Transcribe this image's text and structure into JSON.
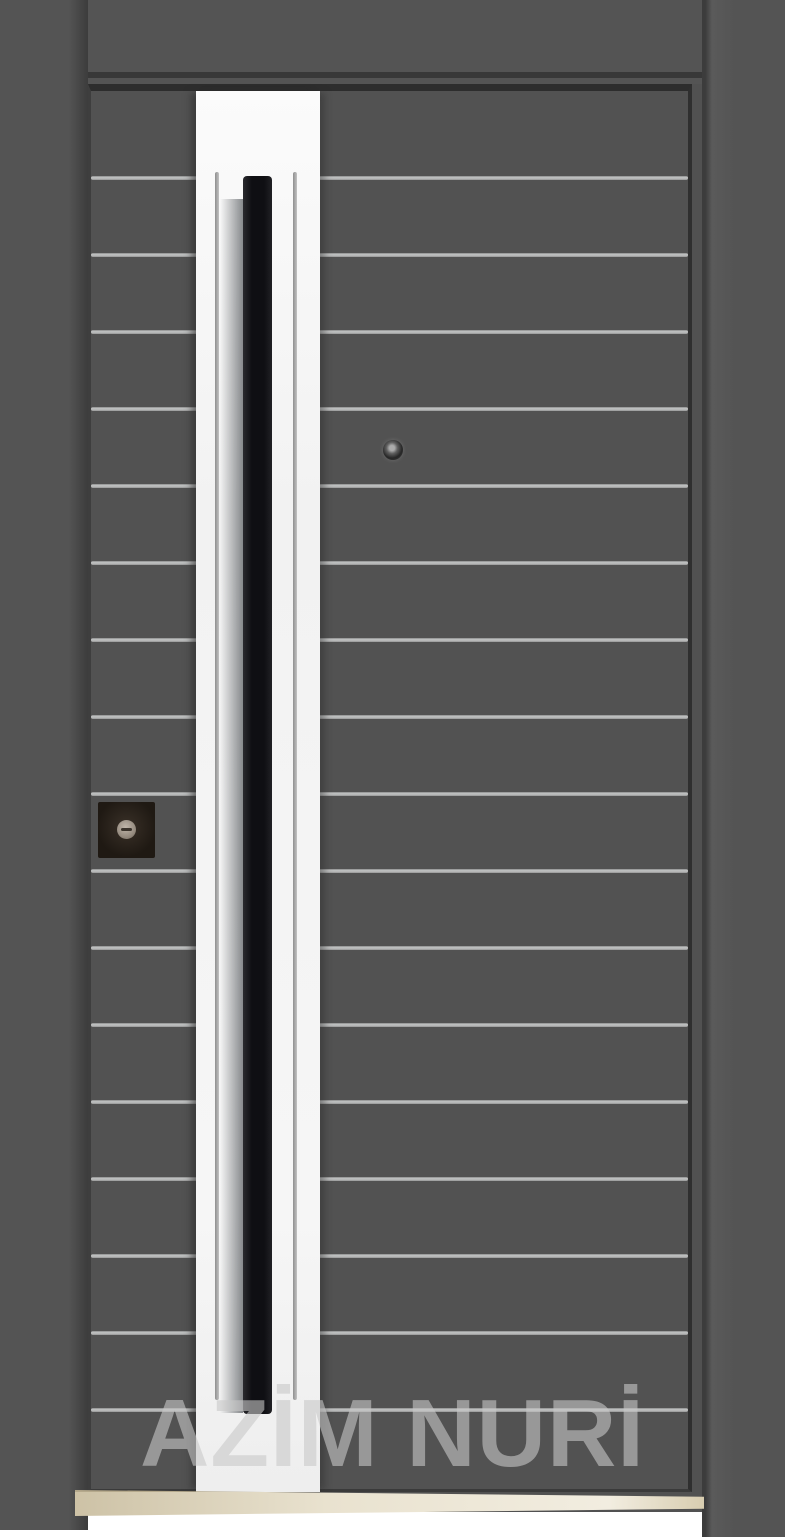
{
  "scene": {
    "type": "product-photo",
    "subject": "steel security door"
  },
  "watermark": {
    "text": "AZİM NURİ"
  },
  "grooves": {
    "count": 17,
    "start_y": 176,
    "step_y": 77
  },
  "colors": {
    "wall": "#515151",
    "frame": "#545454",
    "frame-shadow": "#383838",
    "leaf": "#525252",
    "groove": "#c6c8c8",
    "panel": "#f2f2f2",
    "handle": "#0f0f13",
    "lock": "#1f1913",
    "knob": "#968c80",
    "peephole": "#262626",
    "threshold-edge": "#b5a98c",
    "floor-white": "#ffffff",
    "watermark": "rgba(200,200,200,0.6)"
  }
}
